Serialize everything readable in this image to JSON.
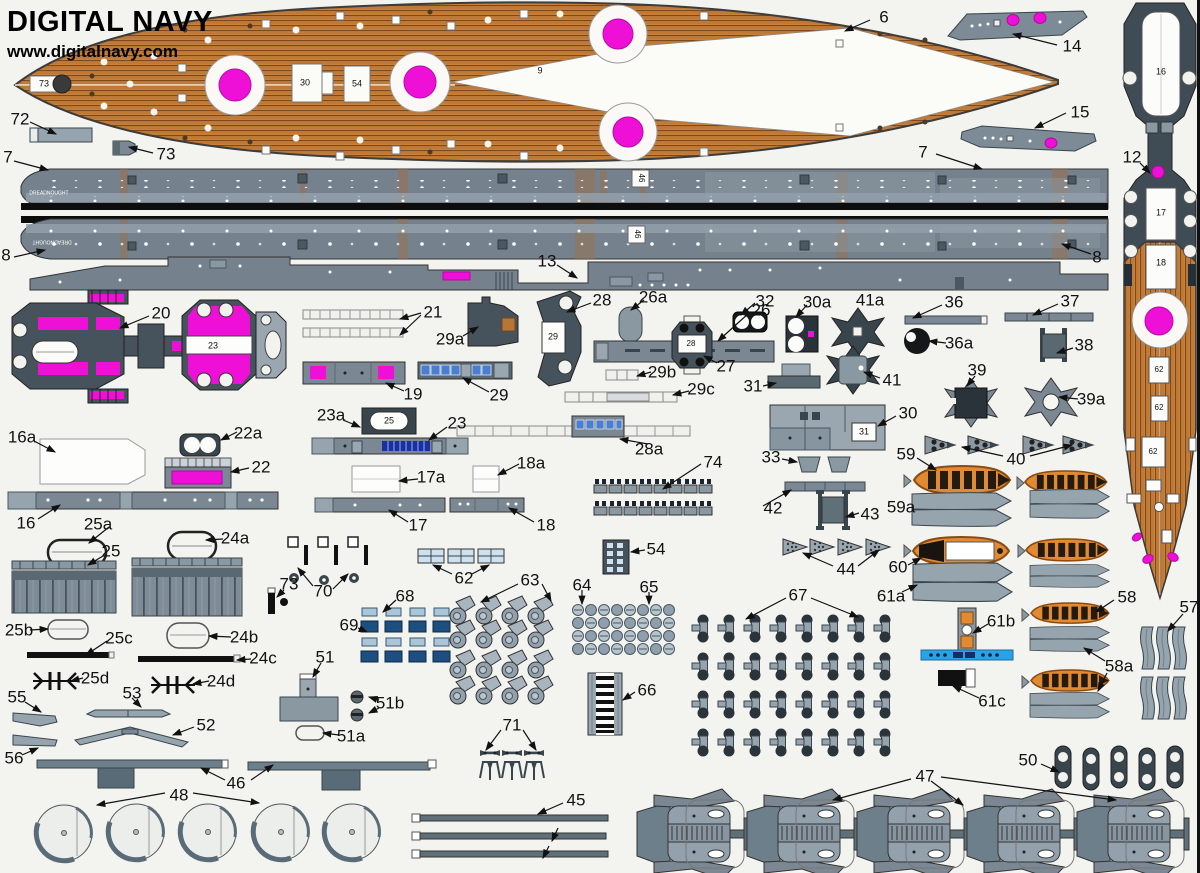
{
  "header": {
    "title": "DIGITAL NAVY",
    "url": "www.digitalnavy.com"
  },
  "colors": {
    "magenta": "#ee10d6",
    "wood": "#c8813c",
    "hull_gray": "#75828d",
    "dark_slate": "#46535c",
    "boat_orange": "#e08a33",
    "window_blue": "#4a7ed0",
    "azure": "#29a3e8",
    "black": "#111111"
  },
  "labels": [
    {
      "t": "6",
      "x": 884,
      "y": 17
    },
    {
      "t": "14",
      "x": 1072,
      "y": 46
    },
    {
      "t": "15",
      "x": 1080,
      "y": 112
    },
    {
      "t": "12",
      "x": 1132,
      "y": 157
    },
    {
      "t": "72",
      "x": 20,
      "y": 119
    },
    {
      "t": "73",
      "x": 166,
      "y": 154
    },
    {
      "t": "7",
      "x": 8,
      "y": 157
    },
    {
      "t": "7",
      "x": 923,
      "y": 152
    },
    {
      "t": "8",
      "x": 6,
      "y": 255
    },
    {
      "t": "8",
      "x": 1097,
      "y": 257
    },
    {
      "t": "13",
      "x": 547,
      "y": 261
    },
    {
      "t": "20",
      "x": 161,
      "y": 313
    },
    {
      "t": "21",
      "x": 433,
      "y": 312
    },
    {
      "t": "29a",
      "x": 450,
      "y": 339
    },
    {
      "t": "28",
      "x": 602,
      "y": 300
    },
    {
      "t": "26a",
      "x": 653,
      "y": 297
    },
    {
      "t": "26",
      "x": 761,
      "y": 310
    },
    {
      "t": "27",
      "x": 726,
      "y": 366
    },
    {
      "t": "32",
      "x": 765,
      "y": 301
    },
    {
      "t": "30a",
      "x": 817,
      "y": 302
    },
    {
      "t": "41a",
      "x": 870,
      "y": 300
    },
    {
      "t": "36",
      "x": 954,
      "y": 302
    },
    {
      "t": "37",
      "x": 1070,
      "y": 301
    },
    {
      "t": "36a",
      "x": 959,
      "y": 343
    },
    {
      "t": "38",
      "x": 1084,
      "y": 345
    },
    {
      "t": "41",
      "x": 892,
      "y": 380
    },
    {
      "t": "39",
      "x": 977,
      "y": 370
    },
    {
      "t": "39a",
      "x": 1091,
      "y": 399
    },
    {
      "t": "19",
      "x": 413,
      "y": 394
    },
    {
      "t": "29",
      "x": 499,
      "y": 395
    },
    {
      "t": "29b",
      "x": 662,
      "y": 372
    },
    {
      "t": "29c",
      "x": 701,
      "y": 389
    },
    {
      "t": "31",
      "x": 753,
      "y": 386
    },
    {
      "t": "30",
      "x": 908,
      "y": 413
    },
    {
      "t": "23a",
      "x": 331,
      "y": 415
    },
    {
      "t": "23",
      "x": 457,
      "y": 423
    },
    {
      "t": "16a",
      "x": 22,
      "y": 437
    },
    {
      "t": "22a",
      "x": 248,
      "y": 433
    },
    {
      "t": "22",
      "x": 261,
      "y": 467
    },
    {
      "t": "16",
      "x": 26,
      "y": 523
    },
    {
      "t": "25a",
      "x": 98,
      "y": 524
    },
    {
      "t": "24a",
      "x": 235,
      "y": 538
    },
    {
      "t": "17a",
      "x": 431,
      "y": 477
    },
    {
      "t": "18a",
      "x": 531,
      "y": 463
    },
    {
      "t": "74",
      "x": 713,
      "y": 462
    },
    {
      "t": "33",
      "x": 771,
      "y": 457
    },
    {
      "t": "17",
      "x": 418,
      "y": 525
    },
    {
      "t": "18",
      "x": 546,
      "y": 525
    },
    {
      "t": "28a",
      "x": 649,
      "y": 449
    },
    {
      "t": "42",
      "x": 773,
      "y": 508
    },
    {
      "t": "43",
      "x": 870,
      "y": 514
    },
    {
      "t": "59",
      "x": 906,
      "y": 454
    },
    {
      "t": "40",
      "x": 1016,
      "y": 459
    },
    {
      "t": "59a",
      "x": 901,
      "y": 507
    },
    {
      "t": "25",
      "x": 111,
      "y": 551
    },
    {
      "t": "54",
      "x": 656,
      "y": 549
    },
    {
      "t": "44",
      "x": 846,
      "y": 569
    },
    {
      "t": "60",
      "x": 898,
      "y": 567
    },
    {
      "t": "61a",
      "x": 891,
      "y": 596
    },
    {
      "t": "62",
      "x": 464,
      "y": 578
    },
    {
      "t": "63",
      "x": 530,
      "y": 580
    },
    {
      "t": "64",
      "x": 582,
      "y": 585
    },
    {
      "t": "65",
      "x": 649,
      "y": 587
    },
    {
      "t": "67",
      "x": 798,
      "y": 595
    },
    {
      "t": "61b",
      "x": 1001,
      "y": 621
    },
    {
      "t": "25b",
      "x": 19,
      "y": 630
    },
    {
      "t": "25c",
      "x": 119,
      "y": 638
    },
    {
      "t": "24b",
      "x": 244,
      "y": 637
    },
    {
      "t": "24c",
      "x": 263,
      "y": 658
    },
    {
      "t": "25d",
      "x": 95,
      "y": 678
    },
    {
      "t": "24d",
      "x": 221,
      "y": 681
    },
    {
      "t": "68",
      "x": 405,
      "y": 596
    },
    {
      "t": "69",
      "x": 349,
      "y": 625
    },
    {
      "t": "70",
      "x": 323,
      "y": 591
    },
    {
      "t": "73",
      "x": 289,
      "y": 584
    },
    {
      "t": "51",
      "x": 325,
      "y": 657
    },
    {
      "t": "66",
      "x": 647,
      "y": 690
    },
    {
      "t": "61c",
      "x": 992,
      "y": 701
    },
    {
      "t": "55",
      "x": 17,
      "y": 697
    },
    {
      "t": "53",
      "x": 132,
      "y": 693
    },
    {
      "t": "56",
      "x": 14,
      "y": 758
    },
    {
      "t": "52",
      "x": 206,
      "y": 725
    },
    {
      "t": "51b",
      "x": 390,
      "y": 703
    },
    {
      "t": "51a",
      "x": 351,
      "y": 736
    },
    {
      "t": "46",
      "x": 236,
      "y": 783
    },
    {
      "t": "71",
      "x": 512,
      "y": 725
    },
    {
      "t": "48",
      "x": 179,
      "y": 795
    },
    {
      "t": "45",
      "x": 576,
      "y": 800
    },
    {
      "t": "47",
      "x": 925,
      "y": 776
    },
    {
      "t": "50",
      "x": 1028,
      "y": 760
    },
    {
      "t": "58",
      "x": 1127,
      "y": 597
    },
    {
      "t": "57",
      "x": 1189,
      "y": 607
    },
    {
      "t": "58a",
      "x": 1119,
      "y": 666
    },
    {
      "t": "9",
      "x": 540,
      "y": 71,
      "s": 9
    },
    {
      "t": "73",
      "x": 44,
      "y": 84,
      "s": 9
    },
    {
      "t": "30",
      "x": 305,
      "y": 83,
      "s": 9
    },
    {
      "t": "54",
      "x": 357,
      "y": 84,
      "s": 9
    },
    {
      "t": "23",
      "x": 213,
      "y": 346,
      "s": 9
    },
    {
      "t": "25",
      "x": 389,
      "y": 421,
      "s": 9
    },
    {
      "t": "29",
      "x": 553,
      "y": 337,
      "s": 9
    },
    {
      "t": "28",
      "x": 691,
      "y": 344,
      "s": 8
    },
    {
      "t": "31",
      "x": 864,
      "y": 432,
      "s": 9
    },
    {
      "t": "16",
      "x": 1161,
      "y": 72,
      "s": 9
    },
    {
      "t": "17",
      "x": 1161,
      "y": 213,
      "s": 9
    },
    {
      "t": "18",
      "x": 1161,
      "y": 263,
      "s": 9
    },
    {
      "t": "62",
      "x": 1159,
      "y": 370,
      "s": 8
    },
    {
      "t": "62",
      "x": 1159,
      "y": 408,
      "s": 8
    },
    {
      "t": "62",
      "x": 1153,
      "y": 452,
      "s": 8
    },
    {
      "t": "DREADNOUGHT",
      "x": 49,
      "y": 194,
      "s": 5,
      "c": "#ffffff"
    },
    {
      "t": "DREADNOUGHT",
      "x": 52,
      "y": 241,
      "s": 5,
      "c": "#ffffff",
      "r": 180
    },
    {
      "t": "46",
      "x": 641,
      "y": 178,
      "s": 8,
      "r": 90
    },
    {
      "t": "46",
      "x": 637,
      "y": 234,
      "s": 8,
      "r": 90
    }
  ],
  "leaders": [
    [
      870,
      20,
      845,
      31
    ],
    [
      1057,
      45,
      1013,
      34
    ],
    [
      1066,
      113,
      1035,
      128
    ],
    [
      1140,
      163,
      1150,
      173
    ],
    [
      30,
      122,
      56,
      134
    ],
    [
      153,
      153,
      129,
      147
    ],
    [
      14,
      161,
      48,
      170
    ],
    [
      936,
      154,
      982,
      169
    ],
    [
      14,
      257,
      45,
      250
    ],
    [
      1091,
      254,
      1062,
      244
    ],
    [
      557,
      265,
      577,
      278
    ],
    [
      149,
      316,
      120,
      328
    ],
    [
      421,
      313,
      400,
      319
    ],
    [
      421,
      315,
      400,
      335
    ],
    [
      463,
      336,
      478,
      327
    ],
    [
      591,
      303,
      567,
      312
    ],
    [
      644,
      300,
      631,
      310
    ],
    [
      749,
      313,
      718,
      341
    ],
    [
      717,
      363,
      704,
      356
    ],
    [
      755,
      303,
      741,
      315
    ],
    [
      807,
      305,
      796,
      317
    ],
    [
      942,
      305,
      913,
      318
    ],
    [
      1058,
      304,
      1033,
      315
    ],
    [
      946,
      343,
      929,
      341
    ],
    [
      1073,
      348,
      1057,
      353
    ],
    [
      880,
      378,
      864,
      372
    ],
    [
      975,
      376,
      967,
      386
    ],
    [
      1078,
      399,
      1059,
      397
    ],
    [
      404,
      391,
      386,
      383
    ],
    [
      489,
      392,
      463,
      378
    ],
    [
      651,
      372,
      637,
      376
    ],
    [
      689,
      391,
      673,
      395
    ],
    [
      763,
      386,
      776,
      383
    ],
    [
      896,
      416,
      878,
      426
    ],
    [
      343,
      420,
      360,
      427
    ],
    [
      447,
      427,
      429,
      440
    ],
    [
      34,
      441,
      55,
      452
    ],
    [
      237,
      432,
      221,
      440
    ],
    [
      249,
      468,
      231,
      472
    ],
    [
      38,
      519,
      60,
      505
    ],
    [
      109,
      527,
      89,
      543
    ],
    [
      223,
      539,
      206,
      540
    ],
    [
      418,
      479,
      399,
      481
    ],
    [
      519,
      464,
      498,
      475
    ],
    [
      701,
      464,
      663,
      489
    ],
    [
      782,
      459,
      797,
      462
    ],
    [
      408,
      522,
      389,
      510
    ],
    [
      534,
      522,
      509,
      508
    ],
    [
      648,
      444,
      620,
      439
    ],
    [
      763,
      506,
      791,
      490
    ],
    [
      859,
      513,
      846,
      517
    ],
    [
      917,
      458,
      936,
      470
    ],
    [
      1003,
      456,
      962,
      447
    ],
    [
      1030,
      456,
      1072,
      445
    ],
    [
      833,
      566,
      803,
      553
    ],
    [
      858,
      566,
      879,
      550
    ],
    [
      908,
      565,
      921,
      558
    ],
    [
      902,
      592,
      917,
      585
    ],
    [
      452,
      574,
      433,
      565
    ],
    [
      472,
      574,
      489,
      565
    ],
    [
      518,
      584,
      481,
      602
    ],
    [
      542,
      584,
      551,
      601
    ],
    [
      582,
      590,
      582,
      604
    ],
    [
      649,
      592,
      649,
      604
    ],
    [
      786,
      598,
      746,
      619
    ],
    [
      811,
      598,
      858,
      617
    ],
    [
      988,
      624,
      973,
      633
    ],
    [
      30,
      630,
      48,
      629
    ],
    [
      107,
      641,
      86,
      655
    ],
    [
      231,
      637,
      209,
      636
    ],
    [
      251,
      659,
      237,
      660
    ],
    [
      83,
      678,
      71,
      681
    ],
    [
      209,
      681,
      193,
      684
    ],
    [
      396,
      600,
      383,
      612
    ],
    [
      358,
      628,
      367,
      632
    ],
    [
      313,
      586,
      298,
      568
    ],
    [
      333,
      589,
      348,
      574
    ],
    [
      284,
      590,
      277,
      597
    ],
    [
      321,
      663,
      313,
      677
    ],
    [
      635,
      692,
      623,
      700
    ],
    [
      979,
      698,
      953,
      686
    ],
    [
      25,
      702,
      41,
      712
    ],
    [
      132,
      698,
      141,
      707
    ],
    [
      22,
      755,
      38,
      748
    ],
    [
      194,
      727,
      173,
      735
    ],
    [
      379,
      700,
      369,
      697
    ],
    [
      379,
      708,
      369,
      713
    ],
    [
      339,
      735,
      323,
      733
    ],
    [
      225,
      780,
      201,
      768
    ],
    [
      251,
      780,
      273,
      765
    ],
    [
      501,
      730,
      486,
      750
    ],
    [
      523,
      730,
      536,
      750
    ],
    [
      165,
      793,
      97,
      805
    ],
    [
      193,
      793,
      259,
      803
    ],
    [
      563,
      803,
      538,
      814
    ],
    [
      558,
      828,
      552,
      841
    ],
    [
      549,
      846,
      543,
      858
    ],
    [
      911,
      779,
      833,
      800
    ],
    [
      931,
      781,
      963,
      805
    ],
    [
      941,
      777,
      1116,
      800
    ],
    [
      1041,
      764,
      1059,
      772
    ],
    [
      1114,
      600,
      1096,
      612
    ],
    [
      1183,
      614,
      1168,
      631
    ],
    [
      1105,
      661,
      1084,
      648
    ],
    [
      1107,
      673,
      1098,
      691
    ],
    [
      103,
      556,
      88,
      565
    ],
    [
      645,
      550,
      631,
      552
    ]
  ]
}
